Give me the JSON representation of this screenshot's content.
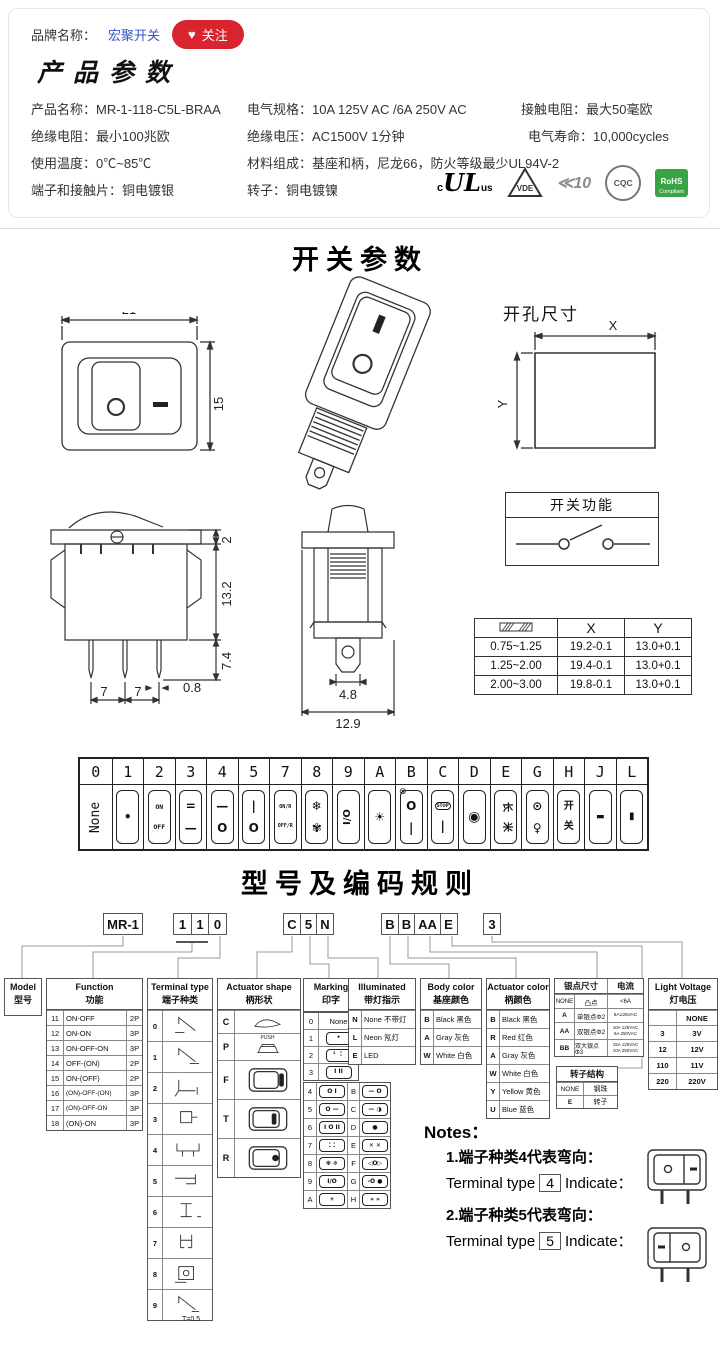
{
  "colors": {
    "accent_red": "#d9232e",
    "link_blue": "#3355cc",
    "rohs_green": "#3aa345"
  },
  "brand": {
    "label": "品牌名称：",
    "name": "宏聚开关",
    "heart": "♥",
    "follow": "关注"
  },
  "product": {
    "title": "产品参数",
    "specs": [
      {
        "label": "产品名称：",
        "value": "MR-1-118-C5L-BRAA"
      },
      {
        "label": "电气规格：",
        "value": "10A  125V  AC /6A 250V  AC"
      },
      {
        "label": "接触电阻：",
        "value": "最大50毫欧"
      },
      {
        "label": "绝缘电阻：",
        "value": "最小100兆欧"
      },
      {
        "label": "绝缘电压：",
        "value": "AC1500V 1分钟"
      },
      {
        "label": "电气寿命：",
        "value": "10,000cycles"
      },
      {
        "label": "使用温度：",
        "value": "0℃~85℃"
      },
      {
        "label": "材料组成：",
        "value": "基座和柄，尼龙66，防火等级最少UL94V-2"
      },
      {
        "label": "端子和接触片：",
        "value": "铜电镀银"
      },
      {
        "label": "转子：",
        "value": "铜电镀镍"
      }
    ],
    "certs": {
      "ul_c": "c",
      "ul_main": "UL",
      "ul_us": "us",
      "vde": "VDE",
      "enec": "≪10",
      "cqc": "CQC",
      "rohs1": "RoHS",
      "rohs2": "Compliant"
    }
  },
  "switch_params": {
    "title": "开关参数",
    "front": {
      "w": "21",
      "h": "15"
    },
    "hole": {
      "title": "开孔尺寸",
      "x": "X",
      "y": "Y"
    },
    "side": {
      "d2": "2",
      "d132": "13.2",
      "d74": "7.4",
      "d08": "0.8",
      "d7a": "7",
      "d7b": "7"
    },
    "profile": {
      "d48": "4.8",
      "d129": "12.9"
    },
    "func_box": {
      "title": "开关功能"
    },
    "panel_table": {
      "x": "X",
      "y": "Y",
      "rows": [
        {
          "t": "0.75~1.25",
          "x": "19.2-0.1",
          "y": "13.0+0.1"
        },
        {
          "t": "1.25~2.00",
          "x": "19.4-0.1",
          "y": "13.0+0.1"
        },
        {
          "t": "2.00~3.00",
          "x": "19.8-0.1",
          "y": "13.0+0.1"
        }
      ]
    }
  },
  "strip": {
    "cols": [
      {
        "code": "0",
        "icon": "none-label",
        "top": "None",
        "bottom": ""
      },
      {
        "code": "1",
        "icon": "dot-marking",
        "top": "•",
        "bottom": ""
      },
      {
        "code": "2",
        "icon": "on-off-text",
        "top": "ON",
        "bottom": "OFF"
      },
      {
        "code": "3",
        "icon": "double-bar-bar",
        "top": "=",
        "bottom": "—"
      },
      {
        "code": "4",
        "icon": "bar-circle",
        "top": "—",
        "bottom": "O"
      },
      {
        "code": "5",
        "icon": "bar-i-circle",
        "top": "|",
        "bottom": "O"
      },
      {
        "code": "7",
        "icon": "onr-offr-text",
        "top": "ON/R",
        "bottom": "OFF/R"
      },
      {
        "code": "8",
        "icon": "snowflake-fan",
        "top": "❄",
        "bottom": "✾"
      },
      {
        "code": "9",
        "icon": "i-slash-o",
        "top": "I/O",
        "bottom": ""
      },
      {
        "code": "A",
        "icon": "lamp-rays",
        "top": "☀",
        "bottom": ""
      },
      {
        "code": "B",
        "icon": "no-lamp-circle-bar",
        "mark": "⊗",
        "top": "O",
        "bottom": "|"
      },
      {
        "code": "C",
        "icon": "stop-bar",
        "top": "STOP",
        "bottom": "|"
      },
      {
        "code": "D",
        "icon": "filled-circle",
        "top": "◉",
        "bottom": ""
      },
      {
        "code": "E",
        "icon": "cjk-pair",
        "top": "长",
        "bottom": "米"
      },
      {
        "code": "G",
        "icon": "circle-dot-lamp",
        "top": "⊙",
        "bottom": "♀"
      },
      {
        "code": "H",
        "icon": "kai-guan",
        "top": "开",
        "bottom": "关"
      },
      {
        "code": "J",
        "icon": "dash-bar",
        "top": "▬",
        "bottom": ""
      },
      {
        "code": "L",
        "icon": "vertical-bar",
        "top": "▮",
        "bottom": ""
      }
    ]
  },
  "coding": {
    "title": "型号及编码规则",
    "codes": {
      "model": "MR-1",
      "d1": "1",
      "d2": "1",
      "d3": "0",
      "c1": "C",
      "c2": "5",
      "c3": "N",
      "b1": "B",
      "b2": "B",
      "b3": "AA",
      "b4": "E",
      "v": "3"
    },
    "model_col": {
      "en": "Model",
      "cn": "型号"
    },
    "function_col": {
      "en": "Function",
      "cn": "功能",
      "rows": [
        {
          "code": "11",
          "fn": "ON-OFF",
          "p": "2P"
        },
        {
          "code": "12",
          "fn": "ON-ON",
          "p": "3P"
        },
        {
          "code": "13",
          "fn": "ON-OFF-ON",
          "p": "3P"
        },
        {
          "code": "14",
          "fn": "OFF-(ON)",
          "p": "2P"
        },
        {
          "code": "15",
          "fn": "ON-(OFF)",
          "p": "2P"
        },
        {
          "code": "16",
          "fn": "(ON)-OFF-(ON)",
          "p": "3P"
        },
        {
          "code": "17",
          "fn": "(ON)-OFF-ON",
          "p": "3P"
        },
        {
          "code": "18",
          "fn": "(ON)-ON",
          "p": "3P"
        }
      ]
    },
    "terminal_col": {
      "en": "Terminal type",
      "cn": "端子种类",
      "codes": [
        "0",
        "1",
        "2",
        "3",
        "4",
        "5",
        "6",
        "7",
        "8",
        "9"
      ],
      "note": "T=0.5"
    },
    "shape_col": {
      "en": "Actuator shape",
      "cn": "柄形状",
      "codes": [
        "C",
        "P",
        "F",
        "T",
        "R"
      ],
      "push": "PUSH"
    },
    "marking_col": {
      "en": "Marking",
      "cn": "印字",
      "single_rows": [
        {
          "code": "0",
          "sym": "None"
        },
        {
          "code": "1",
          "sym": "•"
        },
        {
          "code": "2",
          "sym": "⠃ ⠅"
        },
        {
          "code": "3",
          "sym": "I II"
        }
      ],
      "pair_rows": [
        {
          "c1": "4",
          "s1": "O I",
          "c2": "B",
          "s2": "— O"
        },
        {
          "c1": "5",
          "s1": "O —",
          "c2": "C",
          "s2": "— ◑"
        },
        {
          "c1": "6",
          "s1": "I O II",
          "c2": "D",
          "s2": "●"
        },
        {
          "c1": "7",
          "s1": "⁚ ⁚",
          "c2": "E",
          "s2": "✕ ✕"
        },
        {
          "c1": "8",
          "s1": "✾ ❄",
          "c2": "F",
          "s2": "◁O▷"
        },
        {
          "c1": "9",
          "s1": "I/O",
          "c2": "G",
          "s2": "-O ●"
        },
        {
          "c1": "A",
          "s1": "☀",
          "c2": "H",
          "s2": "» »"
        }
      ]
    },
    "illum_col": {
      "en": "Illuminated",
      "cn": "带灯指示",
      "rows": [
        {
          "code": "N",
          "desc": "None 不带灯"
        },
        {
          "code": "L",
          "desc": "Neon 氖灯"
        },
        {
          "code": "E",
          "desc": "LED"
        }
      ]
    },
    "body_col": {
      "en": "Body color",
      "cn": "基座颜色",
      "rows": [
        {
          "code": "B",
          "desc": "Black 黑色"
        },
        {
          "code": "A",
          "desc": "Gray 灰色"
        },
        {
          "code": "W",
          "desc": "White 白色"
        }
      ]
    },
    "actcolor_col": {
      "en": "Actuator color",
      "cn": "柄颜色",
      "rows": [
        {
          "code": "B",
          "desc": "Black 黑色"
        },
        {
          "code": "R",
          "desc": "Red 红色"
        },
        {
          "code": "A",
          "desc": "Gray 灰色"
        },
        {
          "code": "W",
          "desc": "White 白色"
        },
        {
          "code": "Y",
          "desc": "Yellow 黄色"
        },
        {
          "code": "U",
          "desc": "Blue 蓝色"
        }
      ]
    },
    "silver_col": {
      "h1": "银点尺寸",
      "h2": "电流",
      "rows": [
        {
          "code": "NONE",
          "desc": "凸点",
          "cur1": "<6A",
          "cur2": ""
        },
        {
          "code": "A",
          "desc": "单银点Φ2",
          "cur1": "6A125VAC",
          "cur2": ""
        },
        {
          "code": "AA",
          "desc": "双银点Φ2",
          "cur1": "10A 125VAC",
          "cur2": "6A 250VAC"
        },
        {
          "code": "BB",
          "desc": "双大银点Φ3",
          "cur1": "15A 125VAC",
          "cur2": "10A 250VAC"
        }
      ]
    },
    "rotor_col": {
      "title": "转子结构",
      "rows": [
        {
          "code": "NONE",
          "desc": "钢珠"
        },
        {
          "code": "E",
          "desc": "转子"
        }
      ]
    },
    "voltage_col": {
      "en": "Light Voltage",
      "cn": "灯电压",
      "rows": [
        {
          "code": "",
          "desc": "NONE"
        },
        {
          "code": "3",
          "desc": "3V"
        },
        {
          "code": "12",
          "desc": "12V"
        },
        {
          "code": "110",
          "desc": "11V"
        },
        {
          "code": "220",
          "desc": "220V"
        }
      ]
    },
    "notes": {
      "title": "Notes：",
      "n1": "1.端子种类4代表弯向：",
      "n1_pre": "Terminal type",
      "n1_code": "4",
      "n1_post": "Indicate：",
      "n2": "2.端子种类5代表弯向：",
      "n2_pre": "Terminal type",
      "n2_code": "5",
      "n2_post": "Indicate："
    }
  }
}
